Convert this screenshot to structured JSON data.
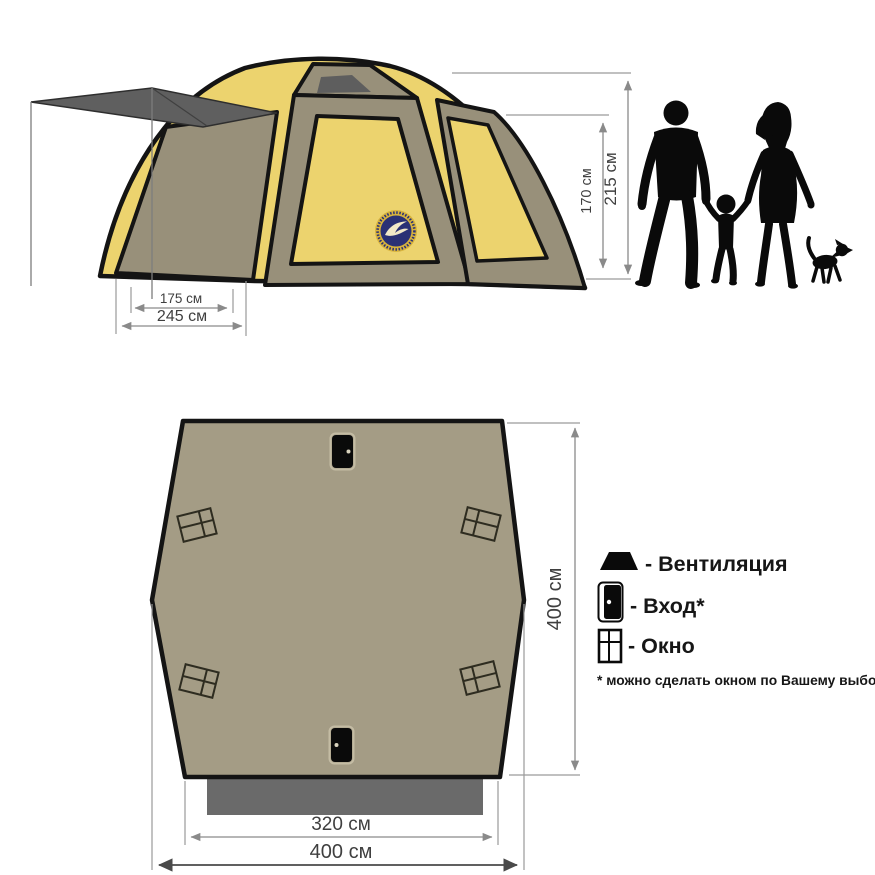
{
  "side_view": {
    "dimensions": {
      "height_inner": "170 см",
      "height_outer": "215 см",
      "width_inner": "175 см",
      "width_outer": "245 см"
    }
  },
  "top_view": {
    "dimensions": {
      "depth": "400 см",
      "entrance_width": "320 см",
      "width": "400 см"
    }
  },
  "legend": {
    "items": [
      {
        "icon": "vent-icon",
        "label": "- Вентиляция"
      },
      {
        "icon": "door-icon",
        "label": "- Вход*"
      },
      {
        "icon": "window-icon",
        "label": "- Окно"
      }
    ],
    "note": "* можно сделать окном по Вашему выбору"
  },
  "colors": {
    "canvas_yellow": "#ecd36e",
    "frame_khaki": "#98907a",
    "plan_khaki": "#a49c85",
    "vent_gray": "#5e5e5e",
    "awning_gray": "#5f5f5f",
    "skirt_gray": "#6a6a6a",
    "dimension_gray": "#8a8a8a",
    "logo_navy": "#2a3175",
    "logo_gold": "#d8b33c"
  }
}
